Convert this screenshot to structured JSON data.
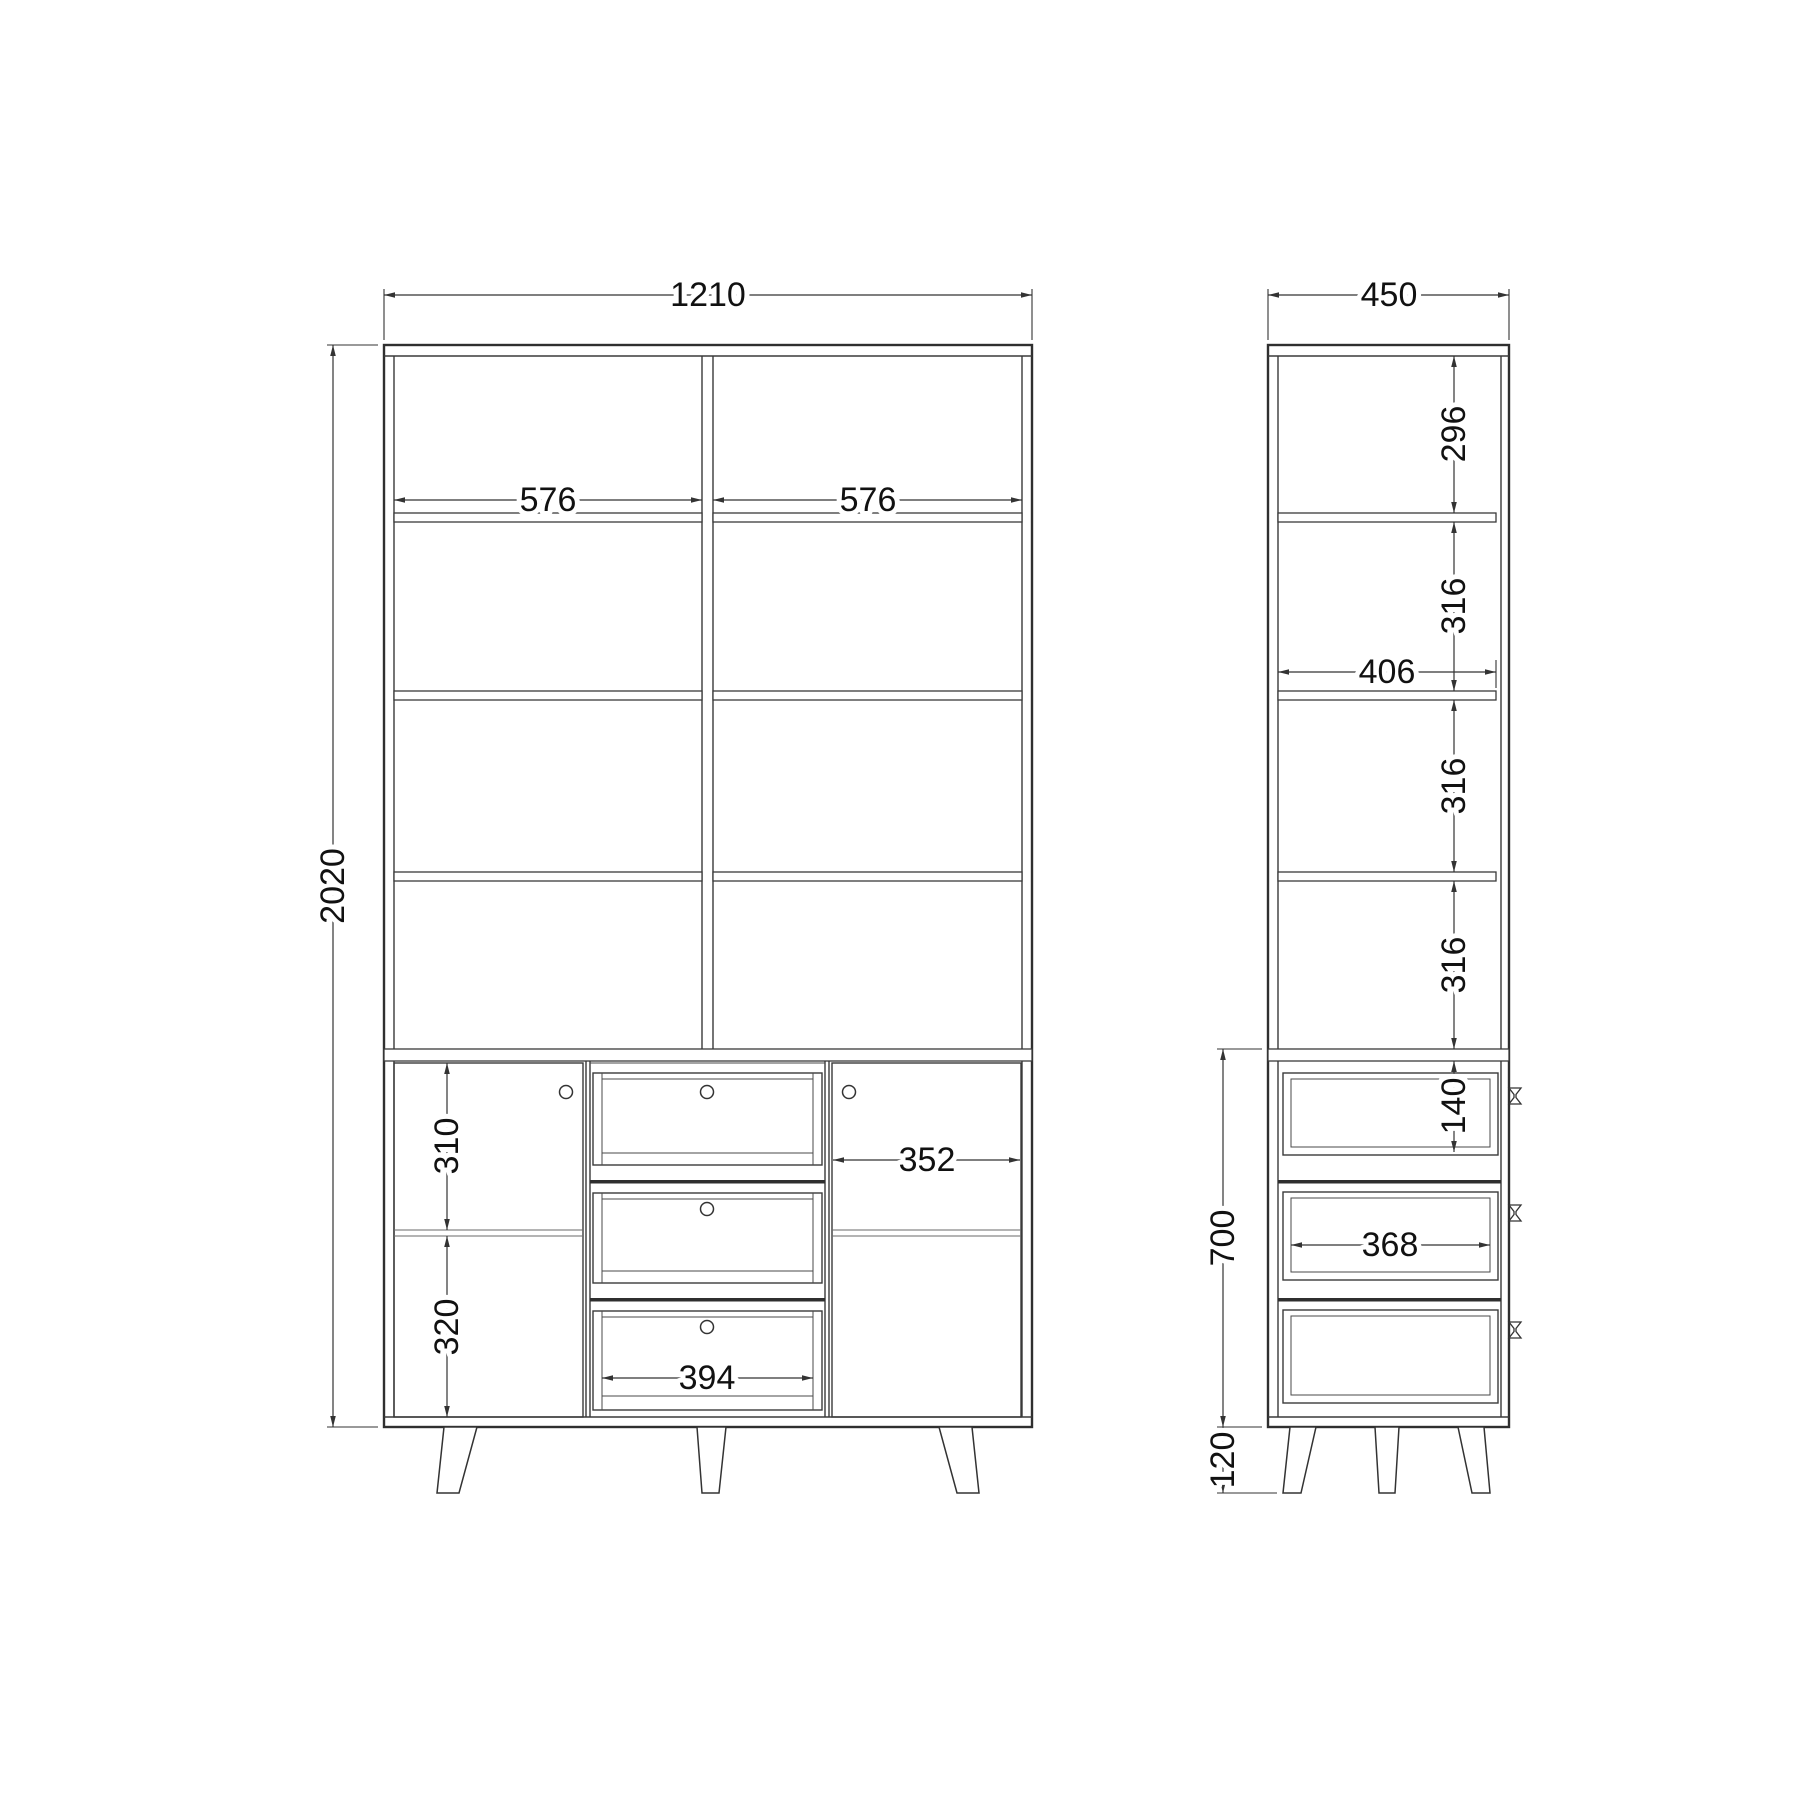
{
  "drawing": {
    "front_view": {
      "overall_width_mm": "1210",
      "overall_height_mm": "2020",
      "left_shelf_opening_mm": "576",
      "right_shelf_opening_mm": "576",
      "door_upper_cell_mm": "310",
      "door_lower_cell_mm": "320",
      "right_door_width_mm": "352",
      "drawer_opening_width_mm": "394"
    },
    "side_view": {
      "overall_depth_mm": "450",
      "top_cell_height_mm": "296",
      "second_cell_height_mm": "316",
      "shelf_depth_mm": "406",
      "third_cell_height_mm": "316",
      "fourth_cell_height_mm": "316",
      "top_drawer_height_mm": "140",
      "base_section_height_mm": "700",
      "drawer_depth_mm": "368",
      "leg_height_mm": "120"
    }
  }
}
